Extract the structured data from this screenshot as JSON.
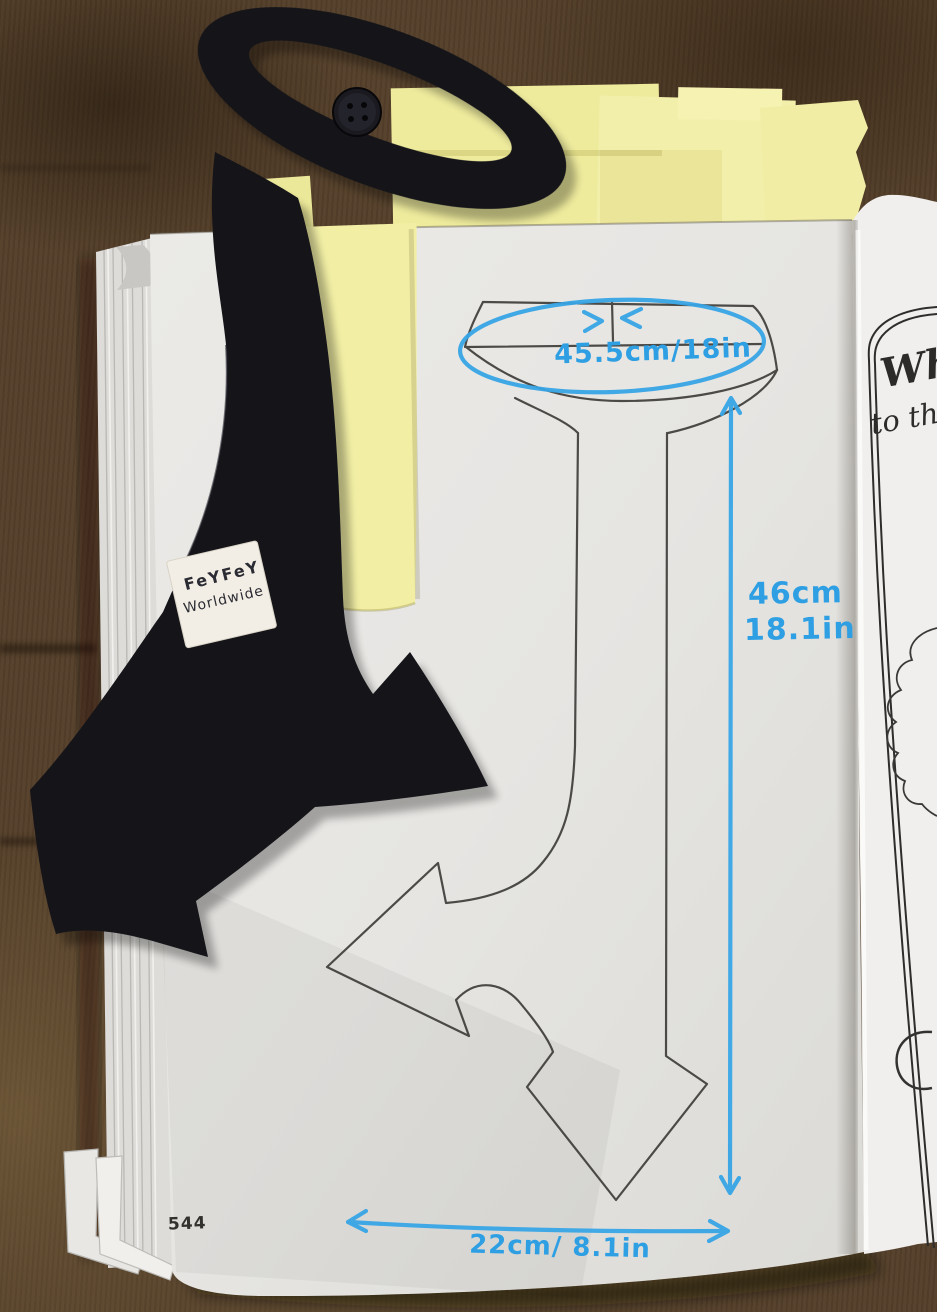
{
  "scene": {
    "description": "Photograph: an open book on a brown wooden table. A black fabric double-headed arrow bookmark with a loop handle and button lies across the left page, which shows a sewing-pattern outline of the same arrow object annotated with blue handwritten measurements. Yellow sticky notes are tucked under the top of the pages."
  },
  "bookmark": {
    "label_line1": "FeYFeY",
    "label_line2": "Worldwide"
  },
  "pattern": {
    "measurement_top": "45.5cm/18in",
    "measurement_side_cm": "46cm",
    "measurement_side_in": "18.1in",
    "measurement_bottom": "22cm/ 8.1in"
  },
  "left_page": {
    "page_number": "544"
  },
  "right_page": {
    "script_line1": "Wha",
    "script_line2": "to tha"
  },
  "colors": {
    "annotation_blue": "#2f9fe3",
    "sticky_yellow": "#f1eda2",
    "wood_brown": "#55402a",
    "fabric_black": "#141419",
    "page_white": "#e8e7e4"
  }
}
